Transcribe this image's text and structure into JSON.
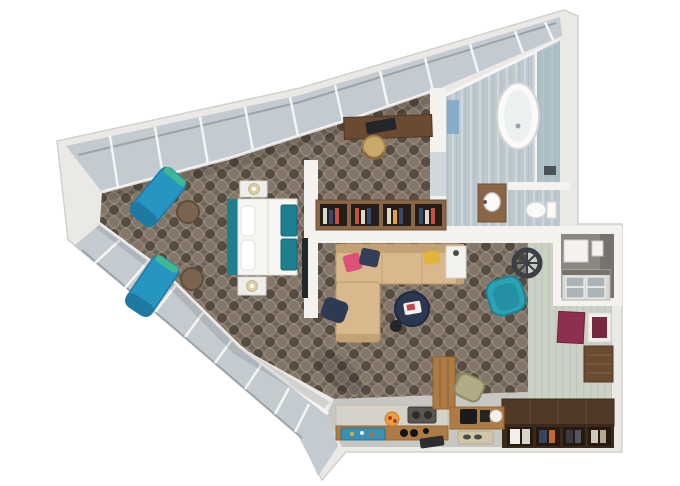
{
  "meta": {
    "title": "3D floor plan render of a wedge-shaped studio suite",
    "canvas": {
      "width": 680,
      "height": 486
    },
    "style": "top-down 3D architectural rendering on a white background, no text labels",
    "footprint": "irregular flat-iron wedge pointing left with full-height angled window walls on the upper-left and lower-left edges"
  },
  "rooms": [
    {
      "id": "bedroom",
      "name": "Bedroom",
      "floor": "dark quatrefoil patterned carpet",
      "furniture": [
        "king bed with teal headboard, white duvet, white pillows and teal folded throws",
        "two white nightstands with cream lamps",
        "two teal chaise lounges by the window wall",
        "two round dark-wood side tables",
        "wall-mounted TV on partition wall",
        "walnut work desk with black laptop",
        "gold tub chair",
        "open bookshelf room divider with books"
      ]
    },
    {
      "id": "bathroom",
      "name": "Bathroom",
      "floor": "light blue-gray marble with vertical veining",
      "furniture": [
        "freestanding oval bathtub",
        "glass walk-in shower",
        "wood vanity with white sink",
        "toilet behind privacy stub wall",
        "blue wall mirror"
      ]
    },
    {
      "id": "living-room",
      "name": "Living room",
      "floor": "dark quatrefoil patterned carpet",
      "furniture": [
        "L-shaped beige sectional sofa with pink, navy and yellow cushions",
        "navy floor pouf",
        "round navy coffee table with white tray",
        "small black side stool",
        "white side table",
        "teal swivel armchair",
        "decorative spoked wheel clock"
      ]
    },
    {
      "id": "kitchen",
      "name": "Kitchenette",
      "floor": "light gray",
      "furniture": [
        "stone counter with teal sink tray and fruit bowl",
        "cooktop with black control knobs",
        "tall wood cabinet",
        "wood appliance counter with coffee machine and white kettle",
        "olive bar stool",
        "beige floor mat",
        "dark door mat"
      ]
    },
    {
      "id": "entry",
      "name": "Entry hall",
      "floor": "pale sage",
      "furniture": [
        "minibar nook with white mini-fridge and glass-front cabinet",
        "two maroon wall-art panels (one white-framed)",
        "dark wood entrance door",
        "dark wood open wardrobe with four bays of shelves and hanging clothes"
      ]
    }
  ],
  "palette": {
    "wall": "#eae9e6",
    "wallFace": "#f3f2ef",
    "wallEdge": "#d2d1cd",
    "glazing": "#c3cad0",
    "glazingEdge": "#9aa3a9",
    "mullion": "#f5f5f3",
    "carpetBase": "#6f655b",
    "carpetDark": "#564b41",
    "carpetLight": "#84776a",
    "carpetLattice": "#9a8c7c",
    "bathFloor": "#bdc9ce",
    "bathStreak": "#cfd8db",
    "bathStreak2": "#b3c0c6",
    "showerTint": "#9fb4bf",
    "sageFloor": "#cbd1c4",
    "sageStripe": "#c1c8ba",
    "kitchenFloor": "#c6c7c2",
    "fixtureWhite": "#fafaf9",
    "fixtureShade": "#edf0f0",
    "fixtureEdge": "#d2d6d6",
    "chaiseBlue": "#2795c2",
    "chaiseBlueDark": "#1f7aa3",
    "chaiseStripe": "#3cb892",
    "bedTeal": "#1d7f8f",
    "linenWhite": "#f6f6f3",
    "nightstand": "#eeedea",
    "lampShade": "#d9cfa8",
    "tvBlack": "#23262b",
    "deskWood": "#6b4a32",
    "chairGold": "#c9a96a",
    "shelfWood": "#8a6646",
    "shelfDark": "#241e18",
    "bookRed": "#c94f43",
    "bookNavy": "#3b4a6b",
    "bookCream": "#ddd8cc",
    "bookYellow": "#e0a23c",
    "sofaTan": "#d8b88c",
    "sofaShade": "#c2a173",
    "pillowPink": "#dd5078",
    "pillowNavy": "#333f57",
    "pillowYellow": "#e2b23c",
    "poufNavy": "#2e3a51",
    "tableNavy": "#2c3850",
    "trayWhite": "#f2f2ef",
    "magRed": "#c64545",
    "sideTableWood": "#7a6450",
    "armchairTeal": "#2aa3b5",
    "armchairTealDark": "#1f8193",
    "clockDark": "#3a4046",
    "nookGray": "#8b8680",
    "nookGrayDark": "#76726c",
    "applianceWhite": "#f3f2ef",
    "cabinetGlass": "#aab4b8",
    "cabinetFrame": "#d9d6d1",
    "maroon": "#8e2f4f",
    "maroonDark": "#7a2840",
    "frameWhite": "#f0efec",
    "doorWood": "#6a4c33",
    "wardrobeTop": "#503a27",
    "wardrobeFront": "#3a2a1c",
    "wardrobeBay": "#26190f",
    "clothNavy": "#37455e",
    "clothOrange": "#c06a2e",
    "clothDark": "#3a3a40",
    "clothLight": "#cfc9bd",
    "stone": "#d6d2ca",
    "counterWood": "#ad7b45",
    "cooktop": "#575652",
    "burner": "#2e2d2b",
    "knobBlack": "#141416",
    "trayTeal": "#3f8fae",
    "fruitOrange": "#e8a23c",
    "fruitRed": "#b23b2e",
    "stoolOlive": "#b0ab84",
    "matBeige": "#cfc5a8",
    "matDark": "#2d2d2f",
    "kettleWhite": "#f2f1ee",
    "machineBlack": "#1b1b1d",
    "mirrorBlue": "#7fa8c9",
    "shadow": "#000000"
  }
}
